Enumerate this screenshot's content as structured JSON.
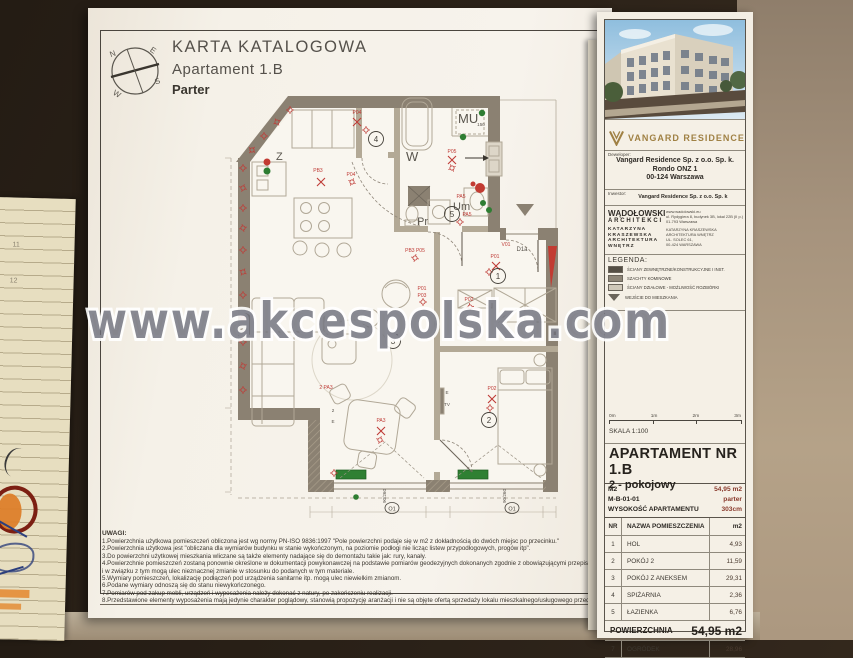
{
  "page": {
    "compass": {
      "n": "N",
      "e": "E",
      "s": "S",
      "w": "W"
    },
    "title": {
      "line1": "KARTA KATALOGOWA",
      "line2": "Apartament 1.B",
      "line3": "Parter"
    },
    "watermark": "www.akcespolska.com",
    "notes_heading": "UWAGI:",
    "notes": [
      "1.Powierzchnia użytkowa pomieszczeń obliczona jest wg normy PN-ISO 9836:1997 \"Pole powierzchni podaje się w m2 z dokładnością do dwóch miejsc po przecinku.\"",
      "2.Powierzchnia użytkowa jest \"obliczana dla wymiarów budynku w stanie wykończonym, na poziomie podłogi nie licząc listew przypodłogowych, progów itp\".",
      "3.Do powierzchni użytkowej mieszkania wliczane są także elementy nadające się do demontażu takie jak: rury, kanały.",
      "4.Powierzchnie pomieszczeń zostaną ponownie określone w dokumentacji powykonawczej na podstawie pomiarów geodezyjnych dokonanych zgodnie z obowiązującymi przepisami pra",
      " i w związku z tym mogą ulec nieznacznej zmianie w stosunku do podanych w tym materiale.",
      "5.Wymiary pomieszczeń, lokalizację podłączeń pod urządzenia sanitarne itp. mogą ulec niewielkim zmianom.",
      "6.Podane wymiary odnoszą się do stanu niewykończonego.",
      "7.Pomiarów pod zakup mebli, urządzeń i wyposażenia należy dokonać z natury, po zakończeniu realizacji.",
      "8.Przedstawione elementy wyposażenia mają jedynie charakter poglądowy, stanowią propozycję aranżacji i nie są objęte ofertą sprzedaży lokalu mieszkalnego/usługowego przedstawio"
    ]
  },
  "plan": {
    "letters": [
      "Z",
      "W",
      "MU",
      "Pr",
      "Um"
    ],
    "nums": [
      "1",
      "2",
      "3",
      "4",
      "5"
    ],
    "fx": [
      "P04",
      "PB3",
      "P04",
      "P05",
      "PA5",
      "PA5",
      "PB3 P05",
      "V01",
      "P01",
      "P02",
      "P01",
      "P03",
      "2 PA3",
      "PA3",
      "P02"
    ],
    "windows": [
      "O1",
      "O1"
    ],
    "dims": [
      "90/260",
      "90/260"
    ],
    "misc": [
      "150",
      "2",
      "E",
      "E",
      "TV",
      "D1a"
    ]
  },
  "panel": {
    "brand": "VANGARD RESIDENCE",
    "developer_label": "Deweloper:",
    "developer_lines": [
      "Vangard Residence Sp. z o.o. Sp. k.",
      "Rondo ONZ 1",
      "00-124 Warszawa"
    ],
    "investor_label": "Inwestor:",
    "investor_value": "Vangard Residence Sp. z o.o. Sp. k",
    "architect": {
      "left": [
        "WĄDOŁOWSKI",
        "ARCHITEKCI",
        "KATARZYNA",
        "KRASZEWSKA",
        "ARCHITEKTURA",
        "WNĘTRZ"
      ],
      "right": [
        "www.wadolowski.eu",
        "ul. Rydygiera 8, budynek 3B, lokal 22B (II p.)",
        "01-793 Warszawa",
        "KATARZYNA KRASZEWSKA ARCHITEKTURA WNĘTRZ",
        "UL. SOLEC 61,",
        "00-424 WARSZAWA"
      ]
    },
    "legend_heading": "LEGENDA:",
    "legend": [
      "ŚCIANY ZEWNĘTRZNE/KONSTRUKCYJNE I INST.",
      "SZACHTY KOMINOWE",
      "ŚCIANY DZIAŁOWE - MOŻLIWOŚĆ ROZBIÓRKI",
      "WEJŚCIE DO MIESZKANIA"
    ],
    "scale": {
      "ticks": [
        "0m",
        "1m",
        "2m",
        "3m"
      ],
      "label": "SKALA 1:100"
    },
    "apartment": {
      "title": "APARTAMENT NR 1.B",
      "subtitle": "2 - pokojowy",
      "info": [
        {
          "label": "M2",
          "value": "54,95 m2"
        },
        {
          "label": "M-B-01-01",
          "value": "parter"
        },
        {
          "label": "WYSOKOŚĆ APARTAMENTU",
          "value": "303cm"
        }
      ]
    },
    "table": {
      "headers": [
        "NR",
        "NAZWA POMIESZCZENIA",
        "m2"
      ],
      "rows": [
        [
          "1",
          "HOL",
          "4,93"
        ],
        [
          "2",
          "POKÓJ 2",
          "11,59"
        ],
        [
          "3",
          "POKÓJ Z ANEKSEM",
          "29,31"
        ],
        [
          "4",
          "SPIŻARNIA",
          "2,36"
        ],
        [
          "5",
          "ŁAZIENKA",
          "6,76"
        ]
      ],
      "summary_label": "POWIERZCHNIA",
      "summary_value": "54,95 m2",
      "extra_row": [
        "7",
        "OGRÓDEK",
        "28,96"
      ]
    }
  },
  "notebook": {
    "numbers": [
      "11",
      "12"
    ]
  },
  "colors": {
    "accent_gold": "#a08144",
    "red_marks": "#bf3b36",
    "green_marks": "#2e7d32",
    "wall": "#8b8172"
  }
}
